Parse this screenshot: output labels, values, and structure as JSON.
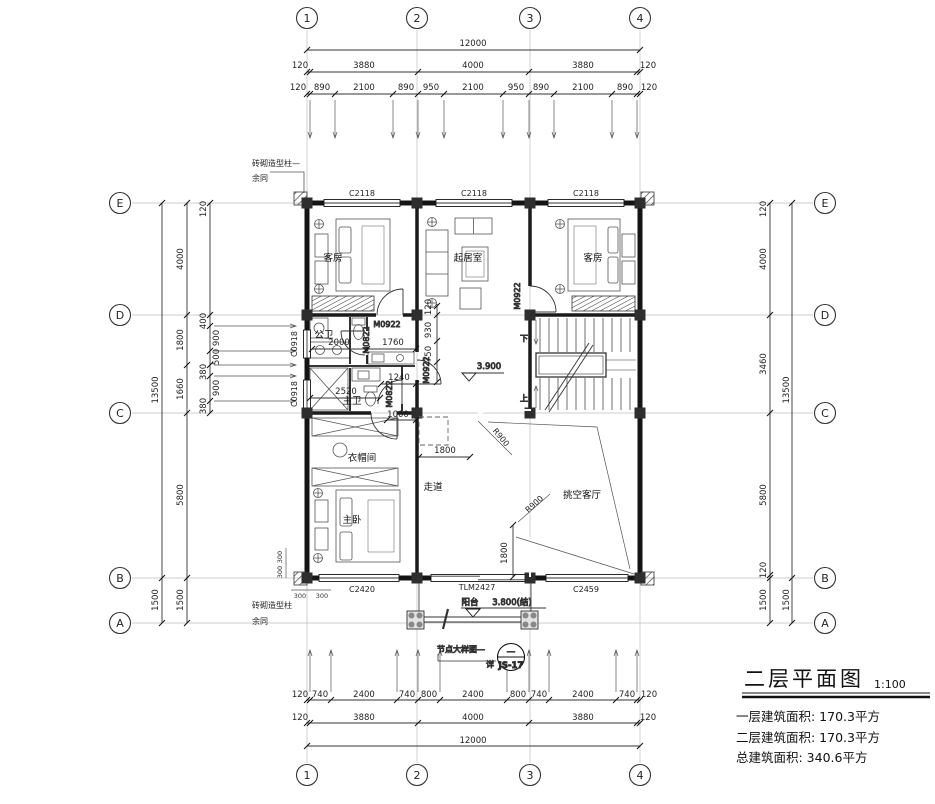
{
  "grid": {
    "cols": [
      "1",
      "2",
      "3",
      "4"
    ],
    "rows": [
      "E",
      "D",
      "C",
      "B",
      "A"
    ]
  },
  "dims": {
    "top_total": "12000",
    "top_major": [
      "120",
      "3880",
      "4000",
      "3880",
      "120"
    ],
    "top_detail": [
      "120",
      "890",
      "2100",
      "890",
      "950",
      "2100",
      "950",
      "890",
      "2100",
      "890",
      "120"
    ],
    "bottom_total": "12000",
    "bottom_major": [
      "120",
      "3880",
      "4000",
      "3880",
      "120"
    ],
    "bottom_detail": [
      "120",
      "740",
      "2400",
      "740",
      "800",
      "2400",
      "800",
      "740",
      "2400",
      "740",
      "120"
    ],
    "left_total": "13500",
    "left_extra": "1500",
    "left_major": [
      "4000",
      "1800",
      "1660",
      "5800",
      "1500"
    ],
    "left_detail": [
      "120",
      "400",
      "900",
      "500",
      "380",
      "900",
      "380"
    ],
    "right_total": "13500",
    "right_extra": "1500",
    "right_major": [
      "120",
      "4000",
      "3460",
      "5800",
      "120",
      "1500"
    ],
    "interior": {
      "d2000": "2000",
      "d1760": "1760",
      "d1240": "1240",
      "d2520": "2520",
      "d1000": "1000",
      "d120": "120",
      "d930": "930",
      "d750": "750",
      "d1800a": "1800",
      "d1800b": "1800",
      "r900": "R900",
      "d300": "300"
    }
  },
  "rooms": {
    "guest": "客房",
    "living": "起居室",
    "wardrobe": "衣帽间",
    "master": "主卧",
    "corridor": "走道",
    "void_hall": "挑空客厅",
    "bath_pub": "公卫",
    "bath_mst": "主卫"
  },
  "openings": {
    "c2118": "C2118",
    "c0918": "C0918",
    "c2420": "C2420",
    "tlm2427": "TLM2427",
    "c2459": "C2459",
    "m0922": "M0922",
    "m0822": "M0822"
  },
  "stairs": {
    "up": "上",
    "down": "下"
  },
  "levels": {
    "floor": "3.900",
    "balcony_name": "阳台",
    "balcony": "3.800(结)"
  },
  "notes": {
    "brick_leader": "砖砌造型柱—",
    "brick": "砖砌造型柱",
    "same": "余同",
    "detail": "节点大样图—",
    "see": "详",
    "ref": "JS-17",
    "dash": "—"
  },
  "title_block": {
    "title": "二层平面图",
    "scale": "1:100",
    "areas": [
      "一层建筑面积: 170.3平方",
      "二层建筑面积: 170.3平方",
      "总建筑面积: 340.6平方"
    ]
  }
}
